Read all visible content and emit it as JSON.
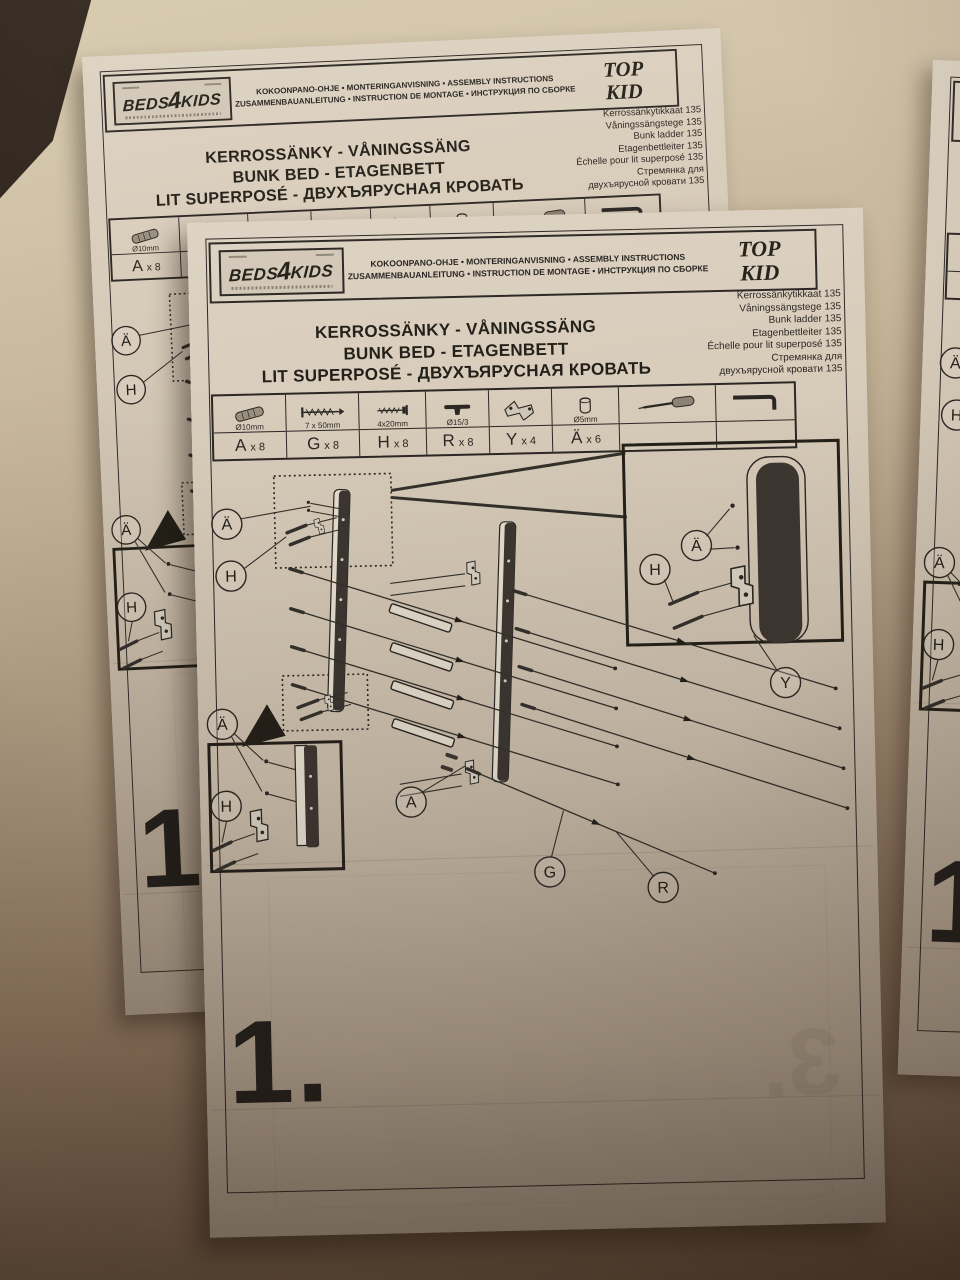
{
  "page": {
    "brand": "BEDS4KIDS",
    "header_line1": "KOKOONPANO-OHJE • MONTERINGANVISNING • ASSEMBLY INSTRUCTIONS",
    "header_line2": "ZUSAMMENBAUANLEITUNG • INSTRUCTION DE MONTAGE • ИНСТРУКЦИЯ ПО СБОРКЕ",
    "model_top": "TOP",
    "model_kid": "KID",
    "product_names": [
      "Kerrossänkytikkaat 135",
      "Våningssängstege 135",
      "Bunk ladder 135",
      "Etagenbettleiter 135",
      "Échelle pour lit superposé 135",
      "Стремянка для",
      "двухъярусной кровати 135"
    ],
    "title_lines": [
      "KERROSSÄNKY - VÅNINGSSÄNG",
      "BUNK BED - ETAGENBETT",
      "LIT SUPERPOSÉ - ДВУХЪЯРУСНАЯ КРОВАТЬ"
    ],
    "step_number": "1.",
    "ghost_step": "3."
  },
  "parts_table": {
    "columns": [
      {
        "icon": "dowel-icon",
        "size": "Ø10mm",
        "label": "A",
        "qty": "x 8",
        "width": 72
      },
      {
        "icon": "long-screw-icon",
        "size": "7 x 50mm",
        "label": "G",
        "qty": "x 8",
        "width": 72
      },
      {
        "icon": "short-screw-icon",
        "size": "4x20mm",
        "label": "H",
        "qty": "x 8",
        "width": 66
      },
      {
        "icon": "cover-cap-icon",
        "size": "Ø15/3",
        "label": "R",
        "qty": "x 8",
        "width": 62
      },
      {
        "icon": "z-bracket-icon",
        "size": "",
        "label": "Y",
        "qty": "x 4",
        "width": 62
      },
      {
        "icon": "cap-nut-icon",
        "size": "Ø5mm",
        "label": "Ä",
        "qty": "x 6",
        "width": 66
      },
      {
        "icon": "screwdriver-icon",
        "size": "",
        "label": "",
        "qty": "",
        "width": 96
      },
      {
        "icon": "allen-key-icon",
        "size": "",
        "label": "",
        "qty": "",
        "width": 78
      }
    ]
  },
  "diagram": {
    "labels": [
      {
        "t": "Ä",
        "x": 33,
        "y": 302
      },
      {
        "t": "H",
        "x": 36,
        "y": 354
      },
      {
        "t": "Ä",
        "x": 24,
        "y": 502
      },
      {
        "t": "H",
        "x": 26,
        "y": 584
      },
      {
        "t": "A",
        "x": 211,
        "y": 584
      },
      {
        "t": "G",
        "x": 348,
        "y": 657
      },
      {
        "t": "R",
        "x": 461,
        "y": 675
      },
      {
        "t": "Ä",
        "x": 502,
        "y": 334
      },
      {
        "t": "H",
        "x": 460,
        "y": 357
      },
      {
        "t": "Y",
        "x": 588,
        "y": 473
      }
    ]
  }
}
